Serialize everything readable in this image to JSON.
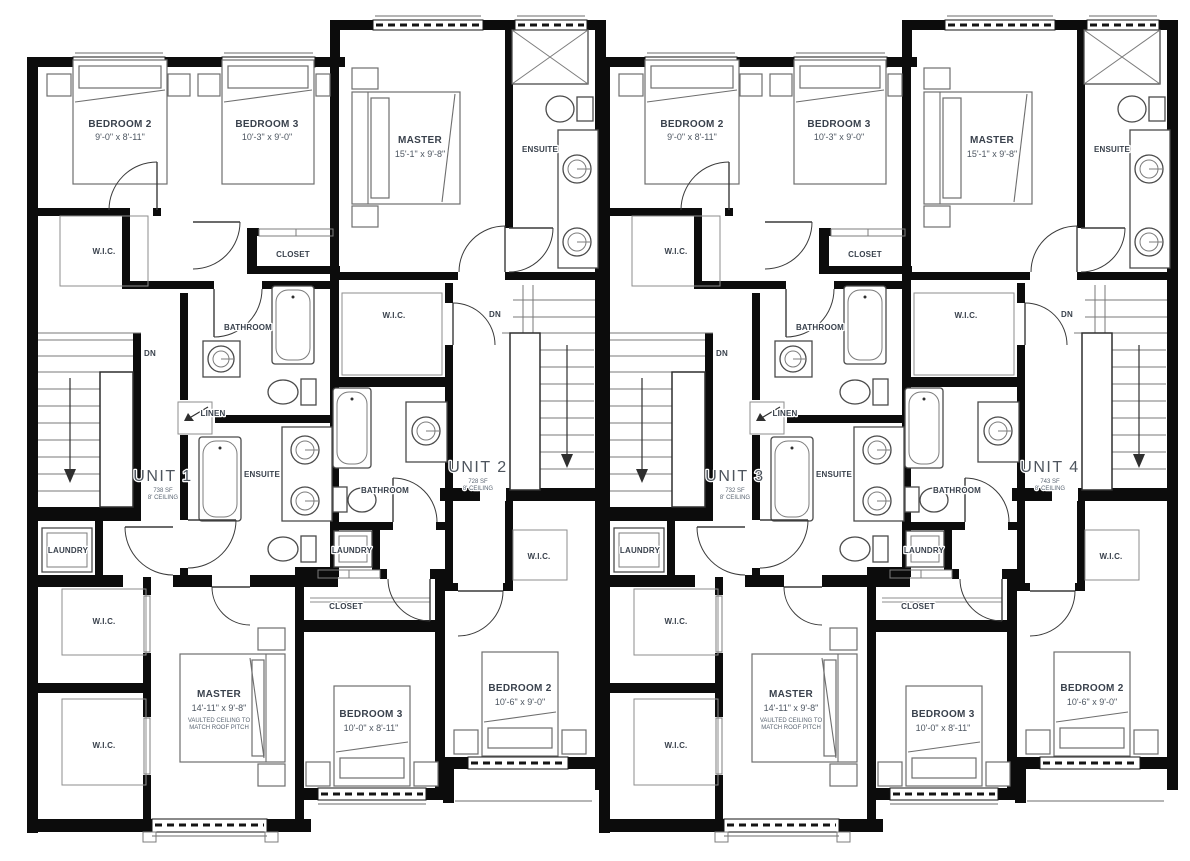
{
  "plan": {
    "type": "floor-plan",
    "colors": {
      "wall": "#0c0c0c",
      "room_label": "#39414c",
      "dimension": "#4d5661",
      "unit_label": "#4e555e",
      "fine_print": "#5b6673",
      "background": "#ffffff"
    },
    "halves": [
      {
        "left": {
          "unit_name": "UNIT 1",
          "unit_area": "738 SF",
          "unit_ceiling": "8' CEILING",
          "bedroom2_name": "BEDROOM 2",
          "bedroom2_dim": "9'-0\" x 8'-11\"",
          "bedroom3_name": "BEDROOM 3",
          "bedroom3_dim": "10'-3\" x 9'-0\"",
          "wic_top": "W.I.C.",
          "closet": "CLOSET",
          "bathroom": "BATHROOM",
          "dn": "DN",
          "linen": "LINEN",
          "ensuite": "ENSUITE",
          "laundry": "LAUNDRY",
          "wic_mid": "W.I.C.",
          "wic_bottom": "W.I.C.",
          "master_name": "MASTER",
          "master_dim": "14'-11\" x 9'-8\"",
          "master_note1": "VAULTED CEILING TO",
          "master_note2": "MATCH ROOF PITCH"
        },
        "right": {
          "unit_name": "UNIT 2",
          "unit_area": "728 SF",
          "unit_ceiling": "8' CEILING",
          "master_name": "MASTER",
          "master_dim": "15'-1\" x 9'-8\"",
          "ensuite": "ENSUITE",
          "wic_top": "W.I.C.",
          "dn": "DN",
          "bathroom": "BATHROOM",
          "laundry": "LAUNDRY",
          "wic_mid": "W.I.C.",
          "closet": "CLOSET",
          "bedroom3_name": "BEDROOM 3",
          "bedroom3_dim": "10'-0\" x 8'-11\"",
          "bedroom2_name": "BEDROOM 2",
          "bedroom2_dim": "10'-6\" x 9'-0\""
        }
      },
      {
        "left": {
          "unit_name": "UNIT 3",
          "unit_area": "732 SF",
          "unit_ceiling": "8' CEILING",
          "bedroom2_name": "BEDROOM 2",
          "bedroom2_dim": "9'-0\" x 8'-11\"",
          "bedroom3_name": "BEDROOM 3",
          "bedroom3_dim": "10'-3\" x 9'-0\"",
          "wic_top": "W.I.C.",
          "closet": "CLOSET",
          "bathroom": "BATHROOM",
          "dn": "DN",
          "linen": "LINEN",
          "ensuite": "ENSUITE",
          "laundry": "LAUNDRY",
          "wic_mid": "W.I.C.",
          "wic_bottom": "W.I.C.",
          "master_name": "MASTER",
          "master_dim": "14'-11\" x 9'-8\"",
          "master_note1": "VAULTED CEILING TO",
          "master_note2": "MATCH ROOF PITCH"
        },
        "right": {
          "unit_name": "UNIT 4",
          "unit_area": "743 SF",
          "unit_ceiling": "8' CEILING",
          "master_name": "MASTER",
          "master_dim": "15'-1\" x 9'-8\"",
          "ensuite": "ENSUITE",
          "wic_top": "W.I.C.",
          "dn": "DN",
          "bathroom": "BATHROOM",
          "laundry": "LAUNDRY",
          "wic_mid": "W.I.C.",
          "closet": "CLOSET",
          "bedroom3_name": "BEDROOM 3",
          "bedroom3_dim": "10'-0\" x 8'-11\"",
          "bedroom2_name": "BEDROOM 2",
          "bedroom2_dim": "10'-6\" x 9'-0\""
        }
      }
    ]
  }
}
